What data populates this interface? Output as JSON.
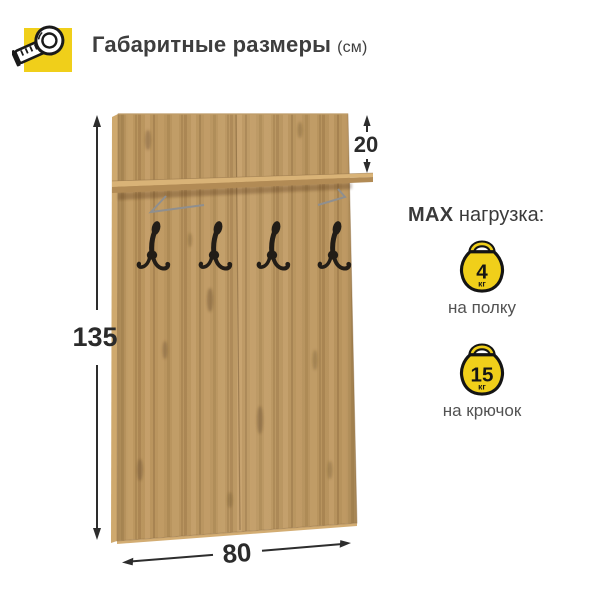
{
  "header": {
    "icon": "measuring-tape-icon",
    "title": "Габаритные размеры",
    "unit_suffix": "(см)"
  },
  "dimensions": {
    "unit": "см",
    "height_cm": "135",
    "shelf_drop_cm": "20",
    "width_cm": "80"
  },
  "product": {
    "type": "wall-coat-rack-panel-with-shelf",
    "hooks_count": 4
  },
  "max_load": {
    "label_strong": "MAX",
    "label_rest": " нагрузка:",
    "items": [
      {
        "value": "4",
        "unit": "кг",
        "target": "на полку"
      },
      {
        "value": "15",
        "unit": "кг",
        "target": "на крючок"
      }
    ]
  },
  "colors": {
    "accent_yellow": "#F0CF1A",
    "wood_base": "#BB965F",
    "wood_light": "#D9B377",
    "hook_black": "#221D17",
    "text_dark": "#3A3A3A",
    "dimension_color": "#2B2B2B",
    "background": "#FFFFFF"
  }
}
